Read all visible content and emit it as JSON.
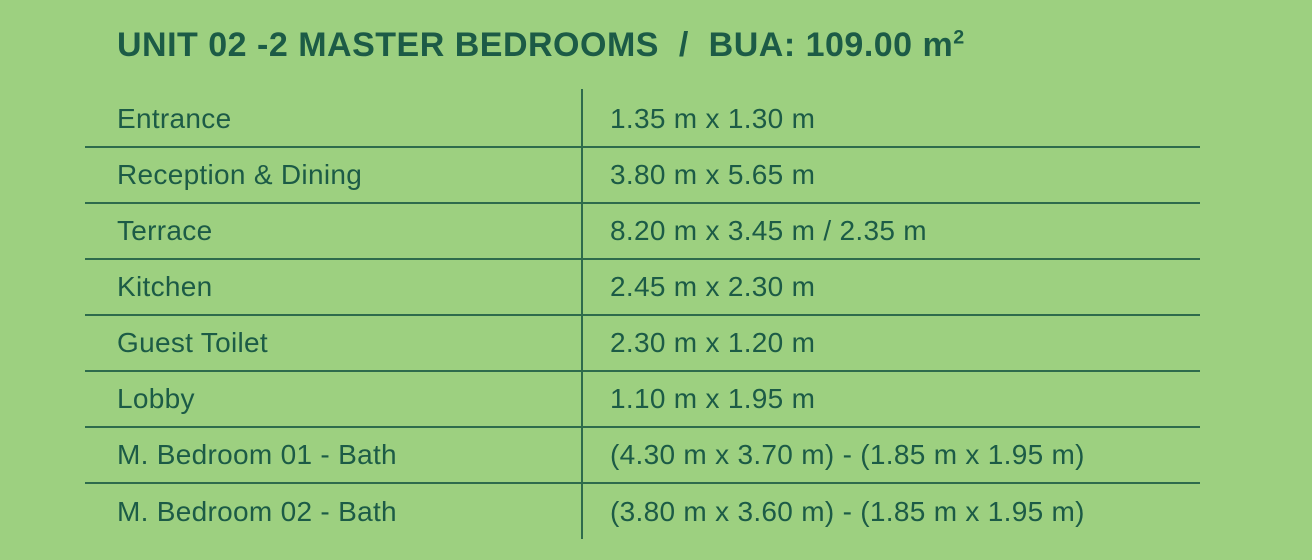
{
  "colors": {
    "background": "#9DD080",
    "text": "#1C5B46",
    "line": "#2E6B4C"
  },
  "title": {
    "main": "UNIT 02 -2 MASTER BEDROOMS  /  BUA: 109.00 m",
    "sup": "2"
  },
  "table": {
    "rows": [
      {
        "label": "Entrance",
        "value": "1.35 m x 1.30 m"
      },
      {
        "label": "Reception & Dining",
        "value": "3.80 m x 5.65 m"
      },
      {
        "label": "Terrace",
        "value": "8.20 m x 3.45 m / 2.35 m"
      },
      {
        "label": "Kitchen",
        "value": "2.45 m x 2.30 m"
      },
      {
        "label": "Guest Toilet",
        "value": "2.30 m x 1.20 m"
      },
      {
        "label": "Lobby",
        "value": "1.10 m x 1.95 m"
      },
      {
        "label": "M. Bedroom 01 - Bath",
        "value": "(4.30 m x 3.70 m) - (1.85 m x 1.95 m)"
      },
      {
        "label": "M. Bedroom 02 - Bath",
        "value": "(3.80 m x 3.60 m) - (1.85 m x 1.95 m)"
      }
    ]
  }
}
